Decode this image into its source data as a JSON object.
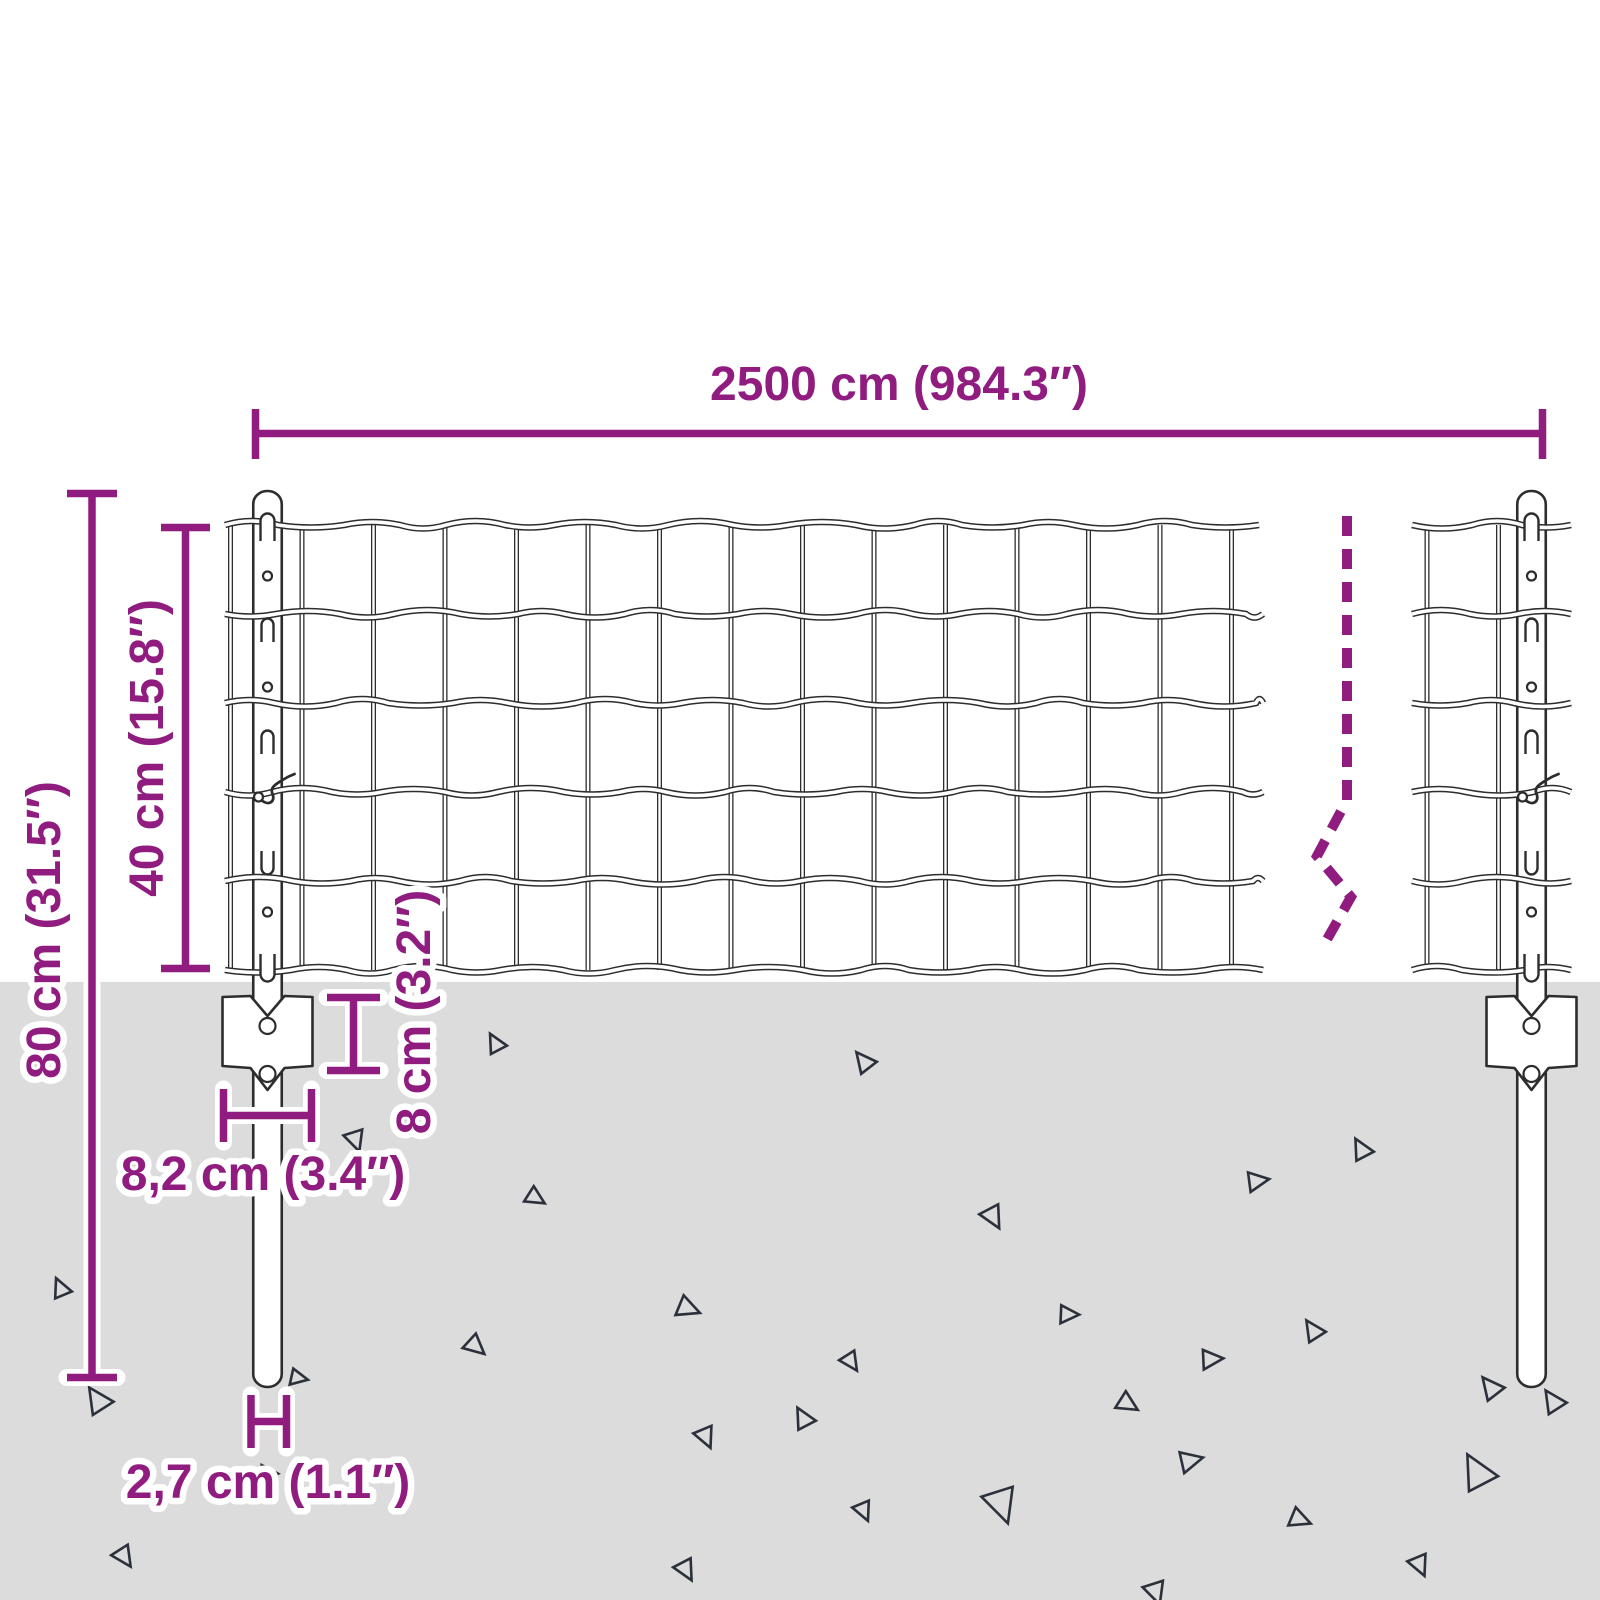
{
  "title": "Fence with posts dimension diagram",
  "colors": {
    "accent": "#901C7F",
    "ground": "#DCDCDC",
    "line": "#2D2D2D",
    "triangle": "#2B303A",
    "background": "#FFFFFF"
  },
  "dimensions": {
    "total_width": {
      "label": "2500 cm (984.3″)"
    },
    "post_height": {
      "label": "80 cm (31.5″)"
    },
    "mesh_height": {
      "label": "40 cm (15.8″)"
    },
    "mesh_opening": {
      "label": "8 cm (3.2″)"
    },
    "bracket_width": {
      "label": "8,2 cm (3.4″)"
    },
    "post_diameter": {
      "label": "2,7 cm (1.1″)"
    }
  },
  "figure": {
    "ground_y": 982,
    "mesh": {
      "rows_y": [
        525,
        614,
        703,
        792,
        881,
        970
      ],
      "sections": [
        {
          "x_start": 225,
          "x_end": 1263,
          "verticals": [
            230.5,
            302,
            373.5,
            445,
            516.5,
            588,
            659.5,
            731,
            802.5,
            874,
            945.5,
            1017,
            1088.5,
            1160,
            1231.5
          ]
        },
        {
          "x_start": 1412,
          "x_end": 1571,
          "verticals": [
            1427,
            1498.5
          ]
        }
      ]
    },
    "posts": [
      {
        "cx": 267.5,
        "top": 491,
        "bottom": 1387,
        "width": 28.5
      },
      {
        "cx": 1531.5,
        "top": 491,
        "bottom": 1387,
        "width": 28.5
      }
    ],
    "post_feature_rows": [
      {
        "type": "hook-top",
        "y": 525
      },
      {
        "type": "hole",
        "y": 576
      },
      {
        "type": "slot-down",
        "y": 630
      },
      {
        "type": "hole",
        "y": 687
      },
      {
        "type": "slot-down",
        "y": 742
      },
      {
        "type": "tie",
        "y": 792
      },
      {
        "type": "slot-up",
        "y": 863
      },
      {
        "type": "hole",
        "y": 912
      },
      {
        "type": "hook-bottom",
        "y": 970
      }
    ],
    "plates": [
      {
        "cx": 267.5
      },
      {
        "cx": 1531.5
      }
    ],
    "plate_geometry": {
      "top": 997,
      "corner_bottom": 1066,
      "dip_top": 1016,
      "dip_bottom": 1090,
      "half_width": 45,
      "hole_r": 8,
      "hole1_y": 1026,
      "hole2_y": 1074
    },
    "break_line": {
      "points": [
        [
          1347,
          516
        ],
        [
          1347,
          800
        ],
        [
          1317,
          856
        ],
        [
          1351,
          897
        ],
        [
          1321,
          950
        ]
      ]
    },
    "triangles": [
      [
        497,
        1045,
        22,
        10
      ],
      [
        354,
        1138,
        24,
        200
      ],
      [
        533,
        1197,
        22,
        160
      ],
      [
        62,
        1290,
        22,
        15
      ],
      [
        685,
        1308,
        26,
        150
      ],
      [
        473,
        1345,
        24,
        170
      ],
      [
        100,
        1402,
        30,
        5
      ],
      [
        296,
        1378,
        20,
        140
      ],
      [
        704,
        1435,
        24,
        195
      ],
      [
        266,
        1474,
        20,
        130
      ],
      [
        122,
        1555,
        24,
        185
      ],
      [
        684,
        1568,
        24,
        190
      ],
      [
        866,
        1063,
        24,
        0
      ],
      [
        991,
        1215,
        26,
        190
      ],
      [
        1255,
        1182,
        24,
        120
      ],
      [
        1363,
        1151,
        24,
        10
      ],
      [
        1066,
        1315,
        22,
        130
      ],
      [
        1315,
        1332,
        24,
        5
      ],
      [
        849,
        1360,
        22,
        185
      ],
      [
        1209,
        1360,
        24,
        125
      ],
      [
        1125,
        1403,
        24,
        160
      ],
      [
        1493,
        1389,
        26,
        0
      ],
      [
        805,
        1420,
        24,
        10
      ],
      [
        862,
        1509,
        22,
        195
      ],
      [
        999,
        1501,
        40,
        200
      ],
      [
        1188,
        1462,
        26,
        115
      ],
      [
        1297,
        1519,
        24,
        150
      ],
      [
        1154,
        1590,
        26,
        200
      ],
      [
        1418,
        1563,
        24,
        195
      ],
      [
        1480,
        1475,
        40,
        10
      ],
      [
        1555,
        1403,
        26,
        5
      ]
    ]
  }
}
